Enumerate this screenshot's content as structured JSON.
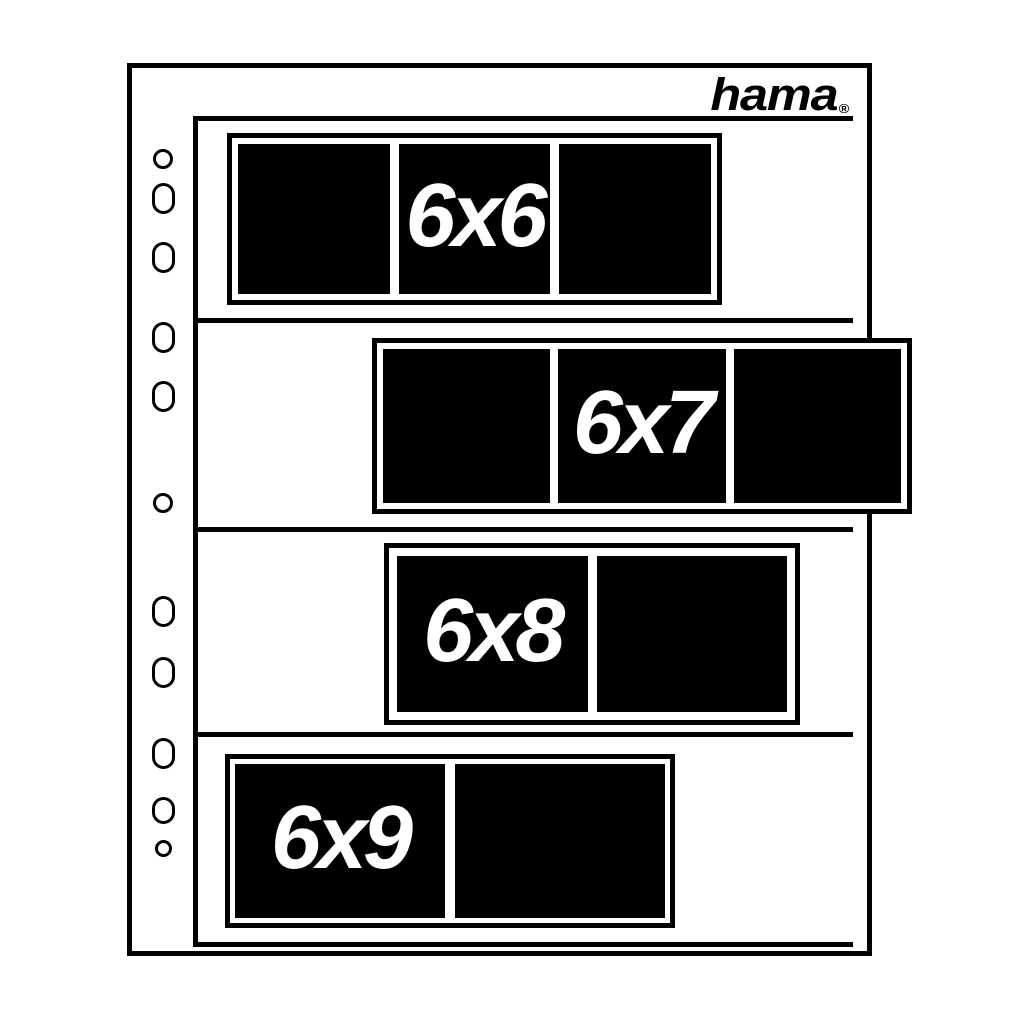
{
  "brand": {
    "logo_text": "hama",
    "registered_mark": "®"
  },
  "palette": {
    "ink": "#000000",
    "paper": "#ffffff",
    "label_text": "#ffffff"
  },
  "formats": [
    {
      "label": "6x6",
      "frame_count": 3,
      "labeled_frame": 1
    },
    {
      "label": "6x7",
      "frame_count": 3,
      "labeled_frame": 1
    },
    {
      "label": "6x8",
      "frame_count": 2,
      "labeled_frame": 0
    },
    {
      "label": "6x9",
      "frame_count": 2,
      "labeled_frame": 0
    }
  ],
  "punch_holes": [
    {
      "shape": "circle",
      "y": 159,
      "w": 20,
      "h": 20
    },
    {
      "shape": "oblong",
      "y": 198,
      "w": 23,
      "h": 31
    },
    {
      "shape": "oblong",
      "y": 257,
      "w": 23,
      "h": 31
    },
    {
      "shape": "oblong",
      "y": 337,
      "w": 23,
      "h": 31
    },
    {
      "shape": "oblong",
      "y": 396,
      "w": 23,
      "h": 31
    },
    {
      "shape": "circle",
      "y": 503,
      "w": 20,
      "h": 20
    },
    {
      "shape": "oblong",
      "y": 611,
      "w": 23,
      "h": 31
    },
    {
      "shape": "oblong",
      "y": 672,
      "w": 23,
      "h": 31
    },
    {
      "shape": "oblong",
      "y": 753,
      "w": 23,
      "h": 31
    },
    {
      "shape": "oblong",
      "y": 810,
      "w": 23,
      "h": 27
    },
    {
      "shape": "circle",
      "y": 848,
      "w": 17,
      "h": 17
    }
  ]
}
